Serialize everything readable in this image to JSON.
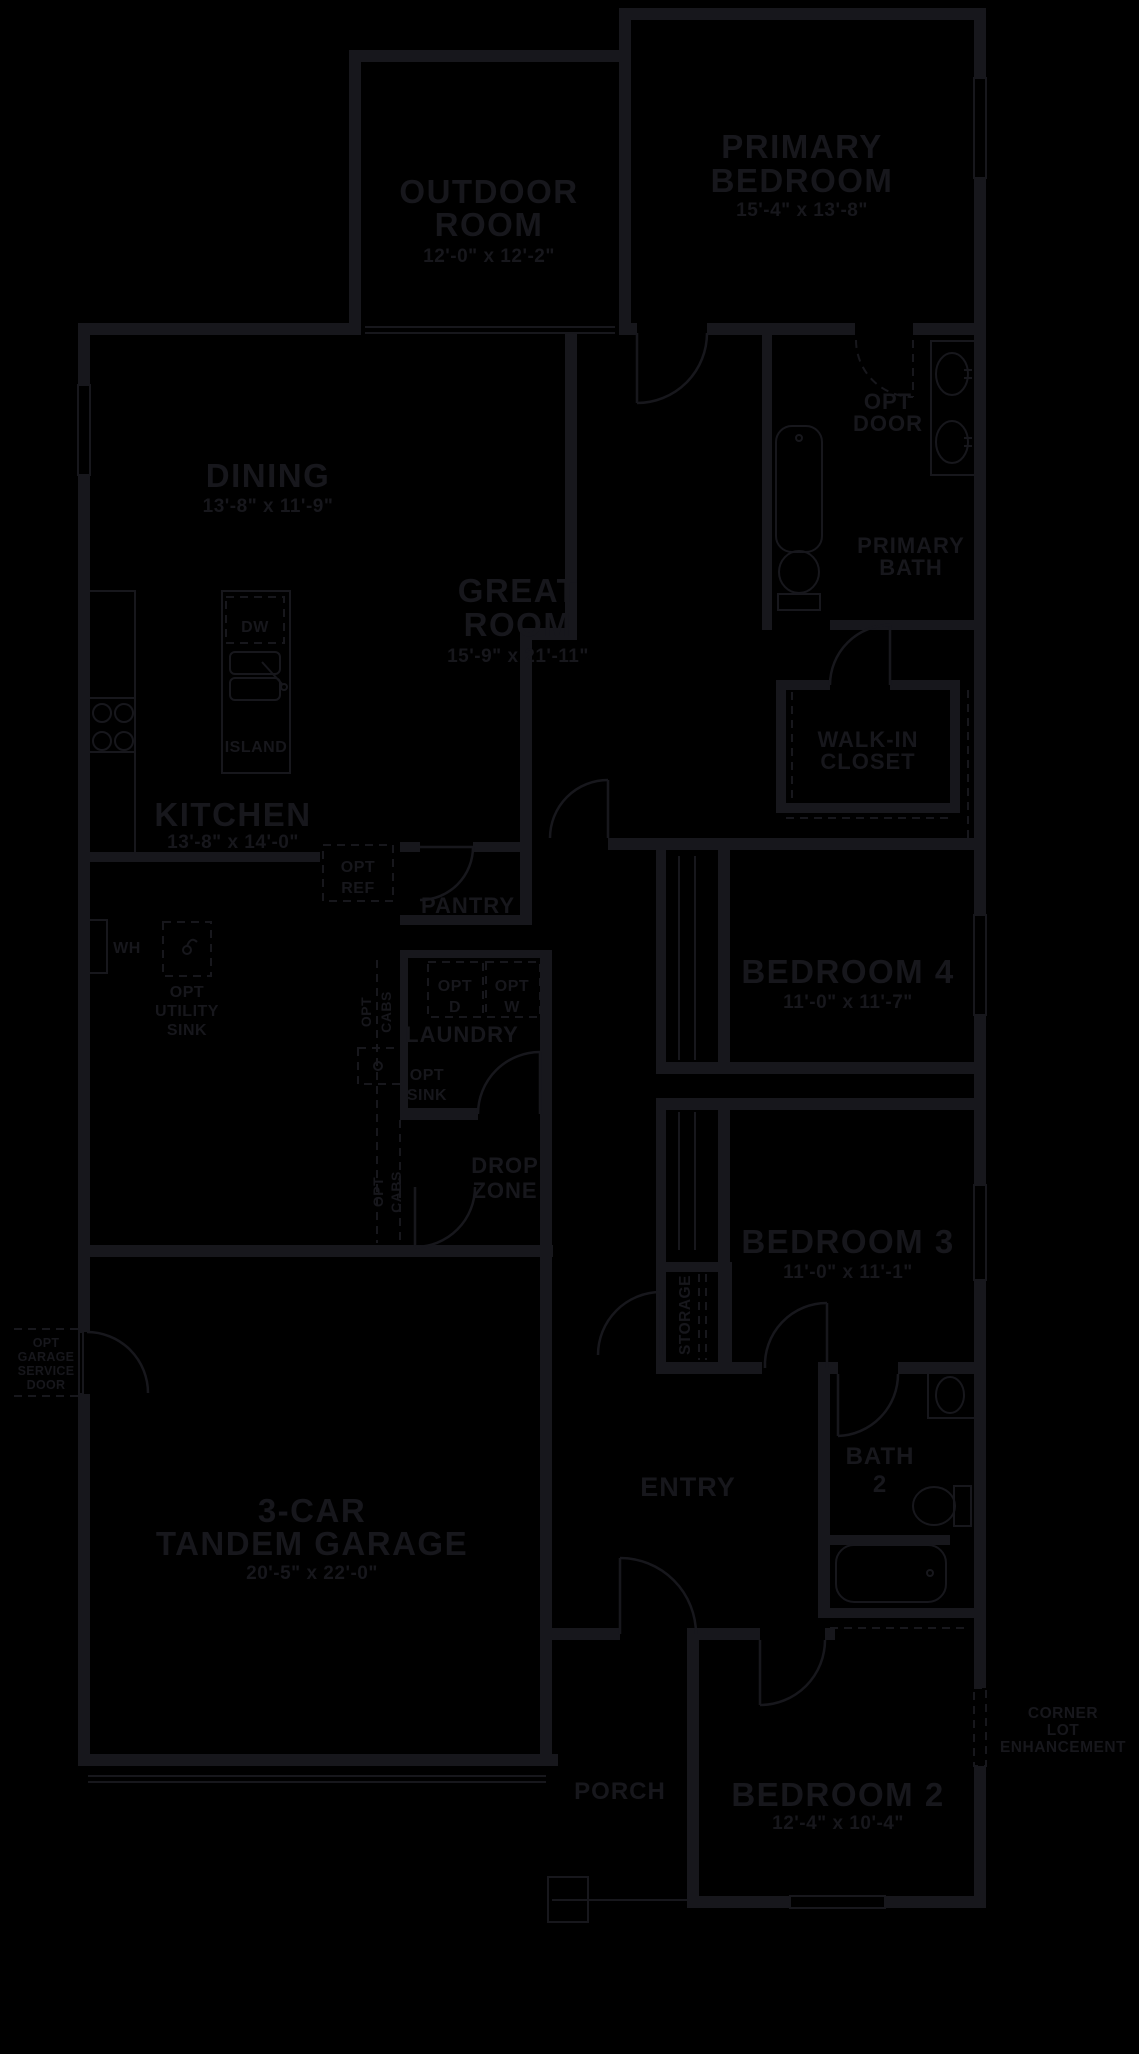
{
  "colors": {
    "background": "#000000",
    "ink": "#17171c"
  },
  "rooms": {
    "outdoor_room": {
      "line1": "OUTDOOR",
      "line2": "ROOM",
      "dims": "12'-0\" x 12'-2\""
    },
    "primary_bedroom": {
      "line1": "PRIMARY",
      "line2": "BEDROOM",
      "dims": "15'-4\" x 13'-8\""
    },
    "dining": {
      "line1": "DINING",
      "dims": "13'-8\" x 11'-9\""
    },
    "great_room": {
      "line1": "GREAT",
      "line2": "ROOM",
      "dims": "15'-9\" x 21'-11\""
    },
    "kitchen": {
      "line1": "KITCHEN",
      "dims": "13'-8\" x 14'-0\""
    },
    "primary_bath": {
      "line1": "PRIMARY",
      "line2": "BATH"
    },
    "walk_in_closet": {
      "line1": "WALK-IN",
      "line2": "CLOSET"
    },
    "pantry": {
      "line1": "PANTRY"
    },
    "laundry": {
      "line1": "LAUNDRY"
    },
    "drop_zone": {
      "line1": "DROP",
      "line2": "ZONE"
    },
    "bedroom4": {
      "line1": "BEDROOM 4",
      "dims": "11'-0\" x 11'-7\""
    },
    "bedroom3": {
      "line1": "BEDROOM 3",
      "dims": "11'-0\" x 11'-1\""
    },
    "bedroom2": {
      "line1": "BEDROOM 2",
      "dims": "12'-4\" x 10'-4\""
    },
    "storage": {
      "line1": "STORAGE"
    },
    "entry": {
      "line1": "ENTRY"
    },
    "bath2": {
      "line1": "BATH",
      "line2": "2"
    },
    "garage": {
      "line1": "3-CAR",
      "line2": "TANDEM GARAGE",
      "dims": "20'-5\" x 22'-0\""
    },
    "porch": {
      "line1": "PORCH"
    }
  },
  "fixtures": {
    "dw": "DW",
    "island": "ISLAND",
    "wh": "WH",
    "opt_ref": {
      "line1": "OPT",
      "line2": "REF"
    },
    "opt_door": {
      "line1": "OPT",
      "line2": "DOOR"
    },
    "opt_d": {
      "line1": "OPT",
      "line2": "D"
    },
    "opt_w": {
      "line1": "OPT",
      "line2": "W"
    },
    "opt_sink": {
      "line1": "OPT",
      "line2": "SINK"
    },
    "opt_utility_sink": {
      "line1": "OPT",
      "line2": "UTILITY",
      "line3": "SINK"
    },
    "opt_cabs": {
      "line1": "OPT",
      "line2": "CABS"
    },
    "opt_garage_service_door": {
      "line1": "OPT",
      "line2": "GARAGE",
      "line3": "SERVICE",
      "line4": "DOOR"
    }
  },
  "annotations": {
    "corner_lot": {
      "line1": "CORNER",
      "line2": "LOT",
      "line3": "ENHANCEMENT"
    }
  }
}
